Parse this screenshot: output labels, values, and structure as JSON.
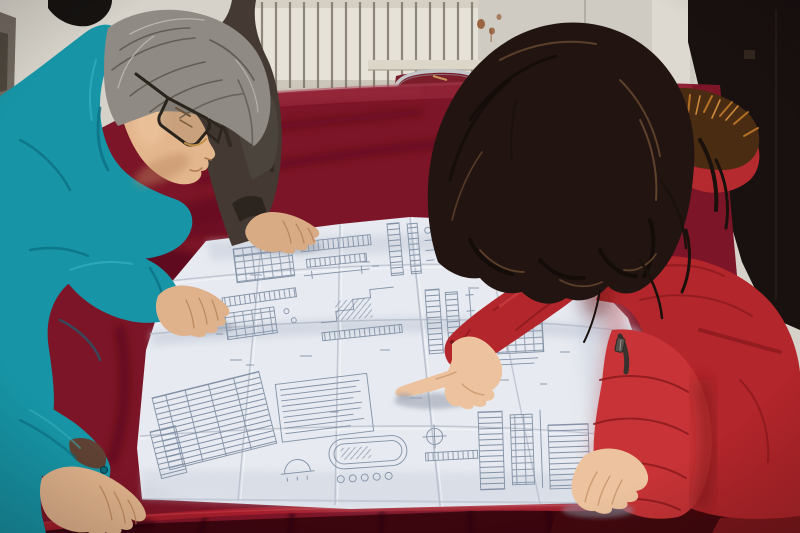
{
  "scene": {
    "labels": {
      "photo": "Two engineers and a colleague leaning over a large unfolded engineering blueprint on a red velvet covered table",
      "background": "Room wall with white radiator and dark doorway",
      "radiator": "White radiator with vertical fins",
      "chair": "Chrome-frame chair with dark red seat behind the table",
      "table": "Large table draped in crimson velvet cloth",
      "blueprint": "Unfolded white construction blueprint with structural detail drawings and schedule tables",
      "man": "Middle-aged engineer with gray hair and glasses wearing a teal work jacket",
      "colleague": "Colleague in a dark jacket resting a hand on the drawing",
      "woman": "Woman in a red down coat with orange fur-trimmed hood",
      "pointing_hand": "Woman's hand pointing at a detail on the blueprint",
      "man_right_hand": "Engineer's right hand resting on the blueprint",
      "man_left_hand": "Engineer's left hand resting on the table corner",
      "woman_left_hand": "Woman's left hand resting on the blueprint"
    }
  },
  "palette": {
    "wall": "#d6d2c9",
    "wall_right": "#cfcbc3",
    "wall_corner": "#ddd8d0",
    "wall_seam": "#a9a49c",
    "door_edge": "#5f574e",
    "radiator": "#e7e2d8",
    "radiator_slat": "#756f64",
    "radiator_shadow": "#b7b0a3",
    "rust": "#8a4a20",
    "dark_bg": "#191110",
    "chrome": "#c3c6c9",
    "chair_seat": "#7c1d2a",
    "velvet_top": "#93253a",
    "velvet_mid": "#7c1527",
    "velvet_dark": "#4d0917",
    "velvet_deep": "#3f0511",
    "velvet_light": "#b04458",
    "velvet_edge": "#a81f2c",
    "velvet_drape": "#3c060f",
    "drape_fold": "#260309",
    "floor_dark": "#42090e",
    "floor_corner": "#8c1d20",
    "paper": "#e7eaf0",
    "paper_shadow": "#c6cdda",
    "crease": "#b6bdca",
    "crease_light": "#f4f6f9",
    "bp_line": "#8291a6",
    "teal": "#1795a6",
    "teal_dark": "#0b6b7d",
    "teal_light": "#3db6c4",
    "cuff_inner": "#5f4233",
    "jacket2": "#443a33",
    "jacket2_dark": "#2c241e",
    "hair_gray": "#8f8a83",
    "hair_gray_dark": "#57514a",
    "hair_gray_light": "#c2beb8",
    "hair_back": "#4a443d",
    "hair2": "#161311",
    "skin_face": "#e3b68d",
    "skin_face_shadow": "#b9865f",
    "skin_hand": "#dfb28b",
    "skin_hand2": "#d9ab84",
    "glasses": "#2a241d",
    "glasses_gold": "#c09048",
    "coat_light": "#c73336",
    "coat_mid": "#b3262b",
    "coat_hood": "#b52a2e",
    "coat_dark": "#8c1a1f",
    "coat_deep": "#6e1216",
    "coat_highlight": "#d04043",
    "fur_base": "#4a2c12",
    "fur_orange": "#c1772a",
    "fur_bright": "#dd9440",
    "hair_w": "#221511",
    "hair_w_dark": "#120b08",
    "hair_w_hl": "#6b4a30",
    "skin_w": "#ecc39e",
    "skin_w_shadow": "#c8956d",
    "zipper": "#38322f",
    "hand_shadow": "#8e96a6"
  }
}
